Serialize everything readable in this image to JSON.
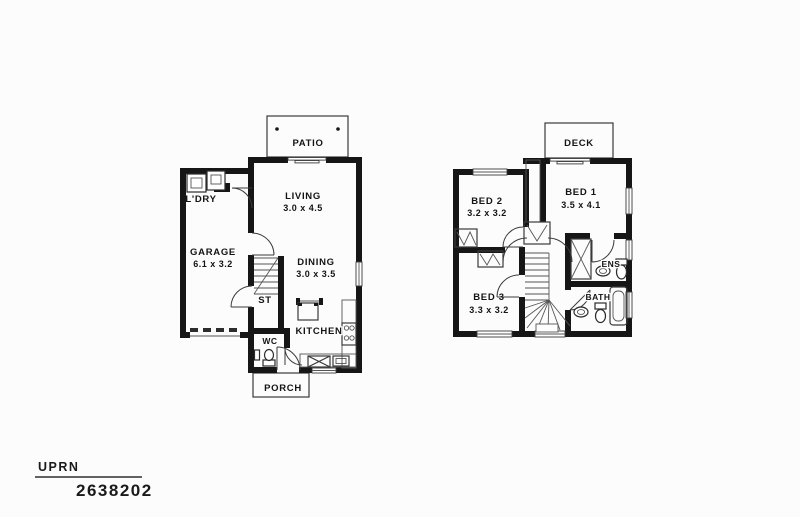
{
  "colors": {
    "background": "#fcfcfc",
    "ink": "#161616",
    "line": "#3a3a3a"
  },
  "ground": {
    "patio": "PATIO",
    "living": {
      "name": "LIVING",
      "dims": "3.0 x 4.5"
    },
    "ldry": "L'DRY",
    "garage": {
      "name": "GARAGE",
      "dims": "6.1 x 3.2"
    },
    "dining": {
      "name": "DINING",
      "dims": "3.0 x 3.5"
    },
    "stairs": "ST",
    "wc": "WC",
    "kitchen": "KITCHEN",
    "porch": "PORCH"
  },
  "upper": {
    "deck": "DECK",
    "bed1": {
      "name": "BED 1",
      "dims": "3.5 x 4.1"
    },
    "bed2": {
      "name": "BED 2",
      "dims": "3.2 x 3.2"
    },
    "bed3": {
      "name": "BED 3",
      "dims": "3.3 x 3.2"
    },
    "ens": "ENS",
    "bath": "BATH"
  },
  "footer": {
    "label": "UPRN",
    "value": "2638202"
  }
}
